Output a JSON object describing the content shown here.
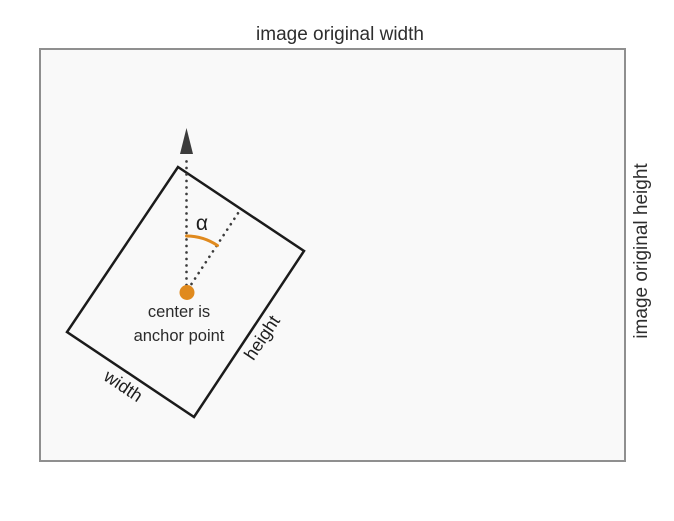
{
  "canvas": {
    "background": "#ffffff"
  },
  "outer_rect": {
    "top_label": "image original width",
    "right_label": "image original height",
    "fill": "#f9f9f9",
    "border_color": "#8f8f8f"
  },
  "rotated_rect": {
    "width_label": "width",
    "height_label": "height",
    "stroke_color": "#1b1b1b"
  },
  "angle": {
    "label": "α",
    "arc_color": "#e08a1e"
  },
  "anchor": {
    "dot_color": "#e08a1e",
    "caption_line1": "center is",
    "caption_line2": "anchor point"
  },
  "colors": {
    "text": "#2e2e2e",
    "dotted_line": "#3c3c3c"
  }
}
